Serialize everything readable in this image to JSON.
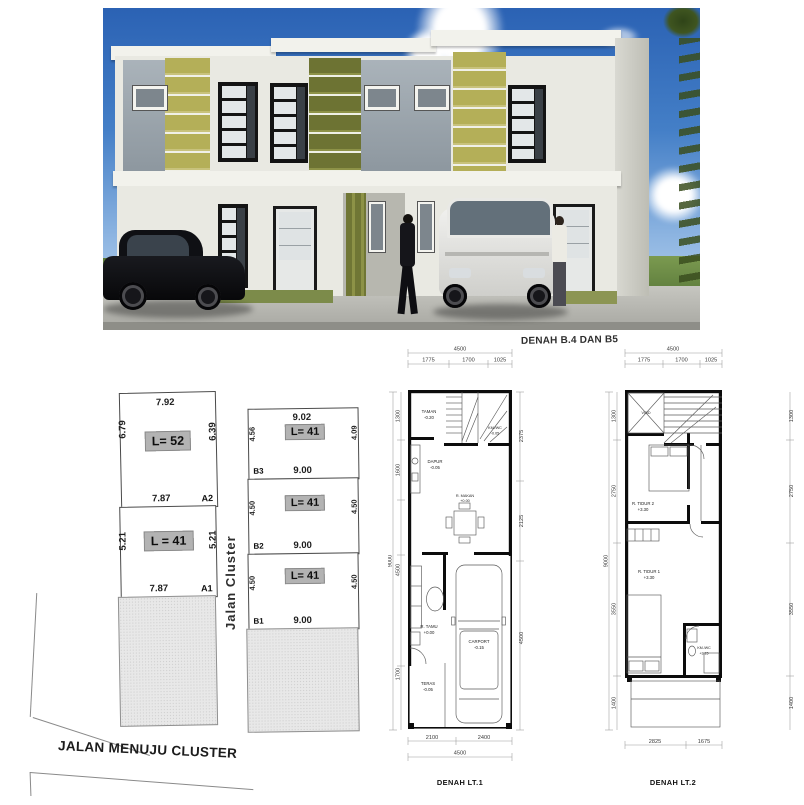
{
  "render": {
    "description": "3D exterior render of three modern two-storey townhouse units",
    "colors": {
      "sky_top": "#2b62b4",
      "sky_horizon": "#c6daf0",
      "accent_yellow_green": "#b4af58",
      "accent_olive": "#6d7333",
      "panel_gray": "#9aa4ac",
      "wall_white": "#efefe9",
      "grass_green": "#6a8a42",
      "pavement_gray": "#b5b5af"
    }
  },
  "site_plan": {
    "street_vertical": "Jalan Cluster",
    "street_bottom": "JALAN MENUJU CLUSTER",
    "lots": [
      {
        "id": "A2",
        "area": "L= 52",
        "top": "7.92",
        "left": "6.79",
        "right": "6.39",
        "bottom": "7.87"
      },
      {
        "id": "A1",
        "area": "L = 41",
        "left": "5.21",
        "right": "5.21",
        "bottom": "7.87"
      },
      {
        "id": "B3",
        "area": "L= 41",
        "top": "9.02",
        "left": "4.56",
        "right": "4.09",
        "bottom": "9.00"
      },
      {
        "id": "B2",
        "area": "L= 41",
        "left": "4.50",
        "right": "4.50",
        "bottom": "9.00"
      },
      {
        "id": "B1",
        "area": "L= 41",
        "left": "4.50",
        "right": "4.50",
        "bottom": "9.00"
      }
    ]
  },
  "plan_lt1": {
    "header": "DENAH B.4 DAN B5",
    "title": "DENAH LT.1",
    "dims_top_total": "4500",
    "dims_top": [
      "1775",
      "1700",
      "1025"
    ],
    "dims_left": [
      "1300",
      "1600",
      "1700"
    ],
    "dims_left_total": "9000",
    "dims_left_inner": "4500",
    "dims_right": [
      "2375",
      "2125",
      "4500"
    ],
    "dims_bottom": [
      "2100",
      "2400"
    ],
    "dims_bottom_total": "4500",
    "rooms": {
      "taman": {
        "name": "TAMAN",
        "level": "-0.20"
      },
      "kmwc": {
        "name": "KM./WC",
        "level": "-0.05"
      },
      "dapur": {
        "name": "DAPUR",
        "level": "-0.05"
      },
      "rmakan": {
        "name": "R. MAKAN",
        "level": "+0.00"
      },
      "rtamu": {
        "name": "R. TAMU",
        "level": "+0.00"
      },
      "teras": {
        "name": "TERAS",
        "level": "-0.05"
      },
      "carport": {
        "name": "CARPORT",
        "level": "-0.15"
      }
    }
  },
  "plan_lt2": {
    "title": "DENAH LT.2",
    "dims_top_total": "4500",
    "dims_top": [
      "1775",
      "1700",
      "1025"
    ],
    "dims_left": [
      "1300",
      "2750",
      "3550",
      "1400"
    ],
    "dims_left_total": "9000",
    "dims_right": [
      "1300",
      "2750",
      "3550",
      "1400"
    ],
    "dims_bottom": [
      "2825",
      "1675"
    ],
    "rooms": {
      "void": {
        "name": "VOID",
        "level": ""
      },
      "rtidur2": {
        "name": "R. TIDUR 2",
        "level": "+3.30"
      },
      "rtidur1": {
        "name": "R. TIDUR 1",
        "level": "+3.30"
      },
      "kmwc": {
        "name": "KM./WC",
        "level": "+3.15"
      }
    }
  }
}
